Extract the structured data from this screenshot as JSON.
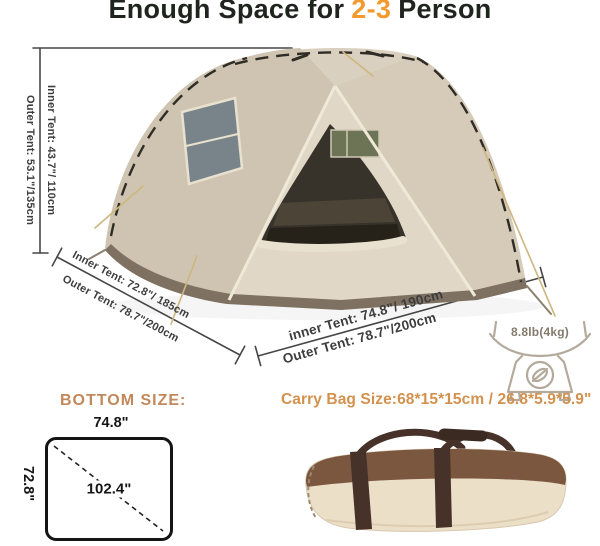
{
  "title": {
    "pre": "Enough Space for",
    "highlight": "2-3",
    "post": "Person"
  },
  "height_dimension": {
    "inner": "Inner Tent: 43.7\"/ 110cm",
    "outer": "Outer Tent: 53.1\"/135cm"
  },
  "width_dimension_left": {
    "inner": "Inner Tent: 72.8\"/ 185cm",
    "outer": "Outer Tent: 78.7\"/200cm"
  },
  "depth_dimension_right": {
    "inner": "inner Tent: 74.8\"/ 190cm",
    "outer": "Outer Tent: 78.7\"/200cm"
  },
  "weight": {
    "label": "8.8lb(4kg)",
    "icon": "kitchen-scale-icon"
  },
  "bottom_size": {
    "heading": "BOTTOM SIZE:",
    "width_label": "74.8\"",
    "height_label": "72.8\"",
    "diagonal_label": "102.4\""
  },
  "carry_bag": {
    "label": "Carry Bag Size:68*15*15cm / 26.8*5.9*5.9\""
  },
  "colors": {
    "accent_orange": "#F29A2E",
    "bottom_heading_tan": "#C3885A",
    "carry_bag_tan": "#D3914E",
    "title_dark": "#20241E",
    "dimension_gray": "#3D3D3D",
    "tent_beige": "#D9D0BF",
    "tent_skirt_brown": "#7E7161",
    "tent_interior_dark": "#37332B",
    "bag_brown": "#7B5740",
    "bag_cream": "#ECDFC8"
  }
}
